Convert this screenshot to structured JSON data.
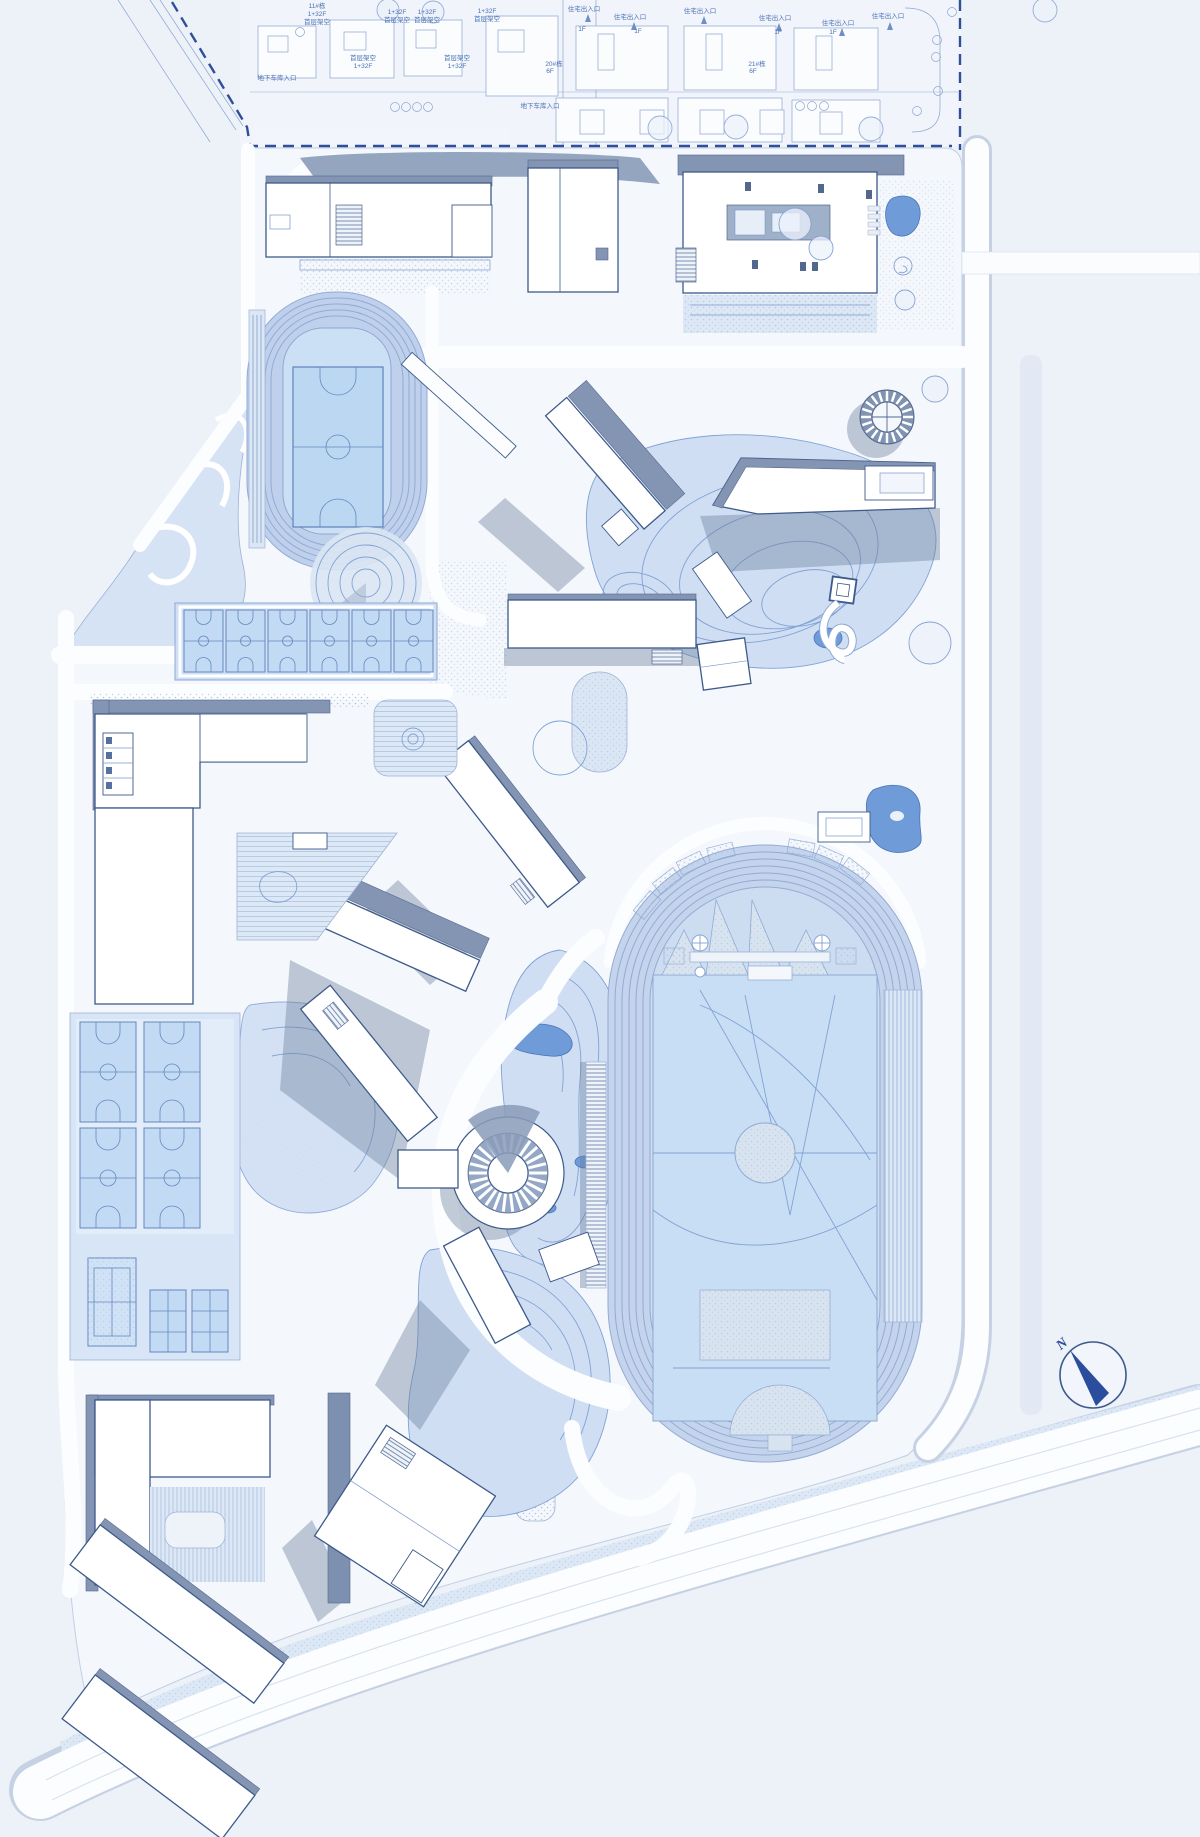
{
  "meta": {
    "drawing": "campus-site-plan"
  },
  "colors": {
    "background": "#edf1f8",
    "parcel": "#f4f7fc",
    "building_fill": "#ffffff",
    "building_outline": "#3d5a8a",
    "roof_shade": "#8494b3",
    "cast_shadow": "rgba(104,124,156,0.40)",
    "contour_fill": "#cfdef3",
    "contour_line": "#82a2d4",
    "water": "#6f9bd8",
    "court_fill": "#c2daf3",
    "court_line": "#6488c0",
    "track_lane": "#bccfeb",
    "stadium_field": "#c8def5",
    "road": "#fcfdff",
    "road_casing": "#c6d2e4",
    "paving": "#dde8f6",
    "boundary_dash": "#2f4f9b",
    "residential_line": "#7b98cc",
    "compass": "#2b4d9e"
  },
  "compass": {
    "label": "N"
  },
  "residential": {
    "labels": [
      {
        "t": "11#栋",
        "x": 317,
        "y": 8
      },
      {
        "t": "1+32F",
        "x": 317,
        "y": 16
      },
      {
        "t": "首层架空",
        "x": 317,
        "y": 24
      },
      {
        "t": "1+32F",
        "x": 397,
        "y": 14
      },
      {
        "t": "首层架空",
        "x": 397,
        "y": 22
      },
      {
        "t": "1+32F",
        "x": 427,
        "y": 14
      },
      {
        "t": "首层架空",
        "x": 427,
        "y": 22
      },
      {
        "t": "1+32F",
        "x": 487,
        "y": 13
      },
      {
        "t": "首层架空",
        "x": 487,
        "y": 21
      },
      {
        "t": "首层架空",
        "x": 363,
        "y": 60
      },
      {
        "t": "1+32F",
        "x": 363,
        "y": 68
      },
      {
        "t": "首层架空",
        "x": 457,
        "y": 60
      },
      {
        "t": "1+32F",
        "x": 457,
        "y": 68
      },
      {
        "t": "地下车库入口",
        "x": 277,
        "y": 80
      },
      {
        "t": "地下车库入口",
        "x": 540,
        "y": 108
      },
      {
        "t": "住宅出入口",
        "x": 584,
        "y": 11
      },
      {
        "t": "住宅出入口",
        "x": 630,
        "y": 19
      },
      {
        "t": "住宅出入口",
        "x": 700,
        "y": 13
      },
      {
        "t": "住宅出入口",
        "x": 775,
        "y": 20
      },
      {
        "t": "住宅出入口",
        "x": 838,
        "y": 25
      },
      {
        "t": "住宅出入口",
        "x": 888,
        "y": 18
      },
      {
        "t": "1F",
        "x": 582,
        "y": 31
      },
      {
        "t": "1F",
        "x": 638,
        "y": 33
      },
      {
        "t": "1F",
        "x": 778,
        "y": 34
      },
      {
        "t": "1F",
        "x": 833,
        "y": 34
      },
      {
        "t": "20#栋",
        "x": 554,
        "y": 66
      },
      {
        "t": "6F",
        "x": 550,
        "y": 73
      },
      {
        "t": "21#栋",
        "x": 757,
        "y": 66
      },
      {
        "t": "6F",
        "x": 753,
        "y": 73
      }
    ]
  },
  "features": {
    "amphitheater": {
      "cx": 508,
      "cy": 1173,
      "r_inner": 21,
      "r_outer": 39,
      "spokes": 26
    },
    "sun_deck": {
      "cx": 887,
      "cy": 417,
      "r_inner": 16,
      "r_outer": 26,
      "spokes": 20
    }
  }
}
